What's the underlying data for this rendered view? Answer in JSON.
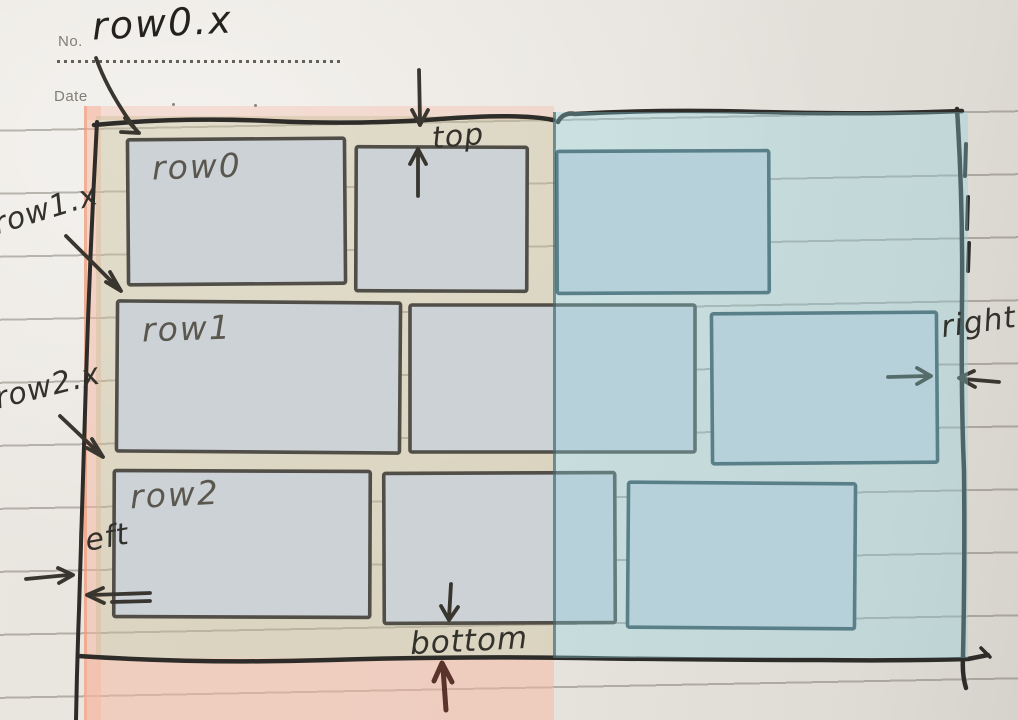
{
  "header": {
    "no_label": "No.",
    "date_label": "Date"
  },
  "annotations": {
    "row0_x": "row0.x",
    "row1_x": "row1.x",
    "row2_x": "row2.x",
    "top": "top",
    "bottom": "bottom",
    "left": "left",
    "right": "right"
  },
  "figure": {
    "type": "hand-drawn layout sketch of three rows of boxes inside a container, left zone highlighted pink, right zone highlighted blue",
    "rows": [
      {
        "label": "row0"
      },
      {
        "label": "row1"
      },
      {
        "label": "row2"
      }
    ],
    "zones": {
      "left": "pink-highlight",
      "right": "blue-highlight"
    },
    "boxes": [
      {
        "row": 0,
        "zone": "left",
        "x": 128,
        "y": 139,
        "w": 217,
        "h": 145
      },
      {
        "row": 0,
        "zone": "left",
        "x": 356,
        "y": 147,
        "w": 171,
        "h": 144
      },
      {
        "row": 0,
        "zone": "right",
        "x": 557,
        "y": 151,
        "w": 212,
        "h": 142
      },
      {
        "row": 1,
        "zone": "left",
        "x": 117,
        "y": 302,
        "w": 283,
        "h": 150
      },
      {
        "row": 1,
        "zone": "left",
        "x": 410,
        "y": 305,
        "w": 285,
        "h": 147
      },
      {
        "row": 1,
        "zone": "right",
        "x": 712,
        "y": 313,
        "w": 225,
        "h": 150
      },
      {
        "row": 2,
        "zone": "left",
        "x": 114,
        "y": 471,
        "w": 256,
        "h": 146
      },
      {
        "row": 2,
        "zone": "left",
        "x": 384,
        "y": 473,
        "w": 231,
        "h": 150
      },
      {
        "row": 2,
        "zone": "right",
        "x": 628,
        "y": 483,
        "w": 227,
        "h": 145
      }
    ],
    "colors": {
      "pink_overlay": "#f3b9a3",
      "blue_overlay": "#a8d6d8",
      "box_fill": "#cdd2d7",
      "ink": "#2d2c28",
      "pencil": "#55524b",
      "maroon_arrow": "#5a332a",
      "left_zone_box_stroke": "#504e47",
      "right_zone_box_stroke": "#3e545c"
    }
  }
}
